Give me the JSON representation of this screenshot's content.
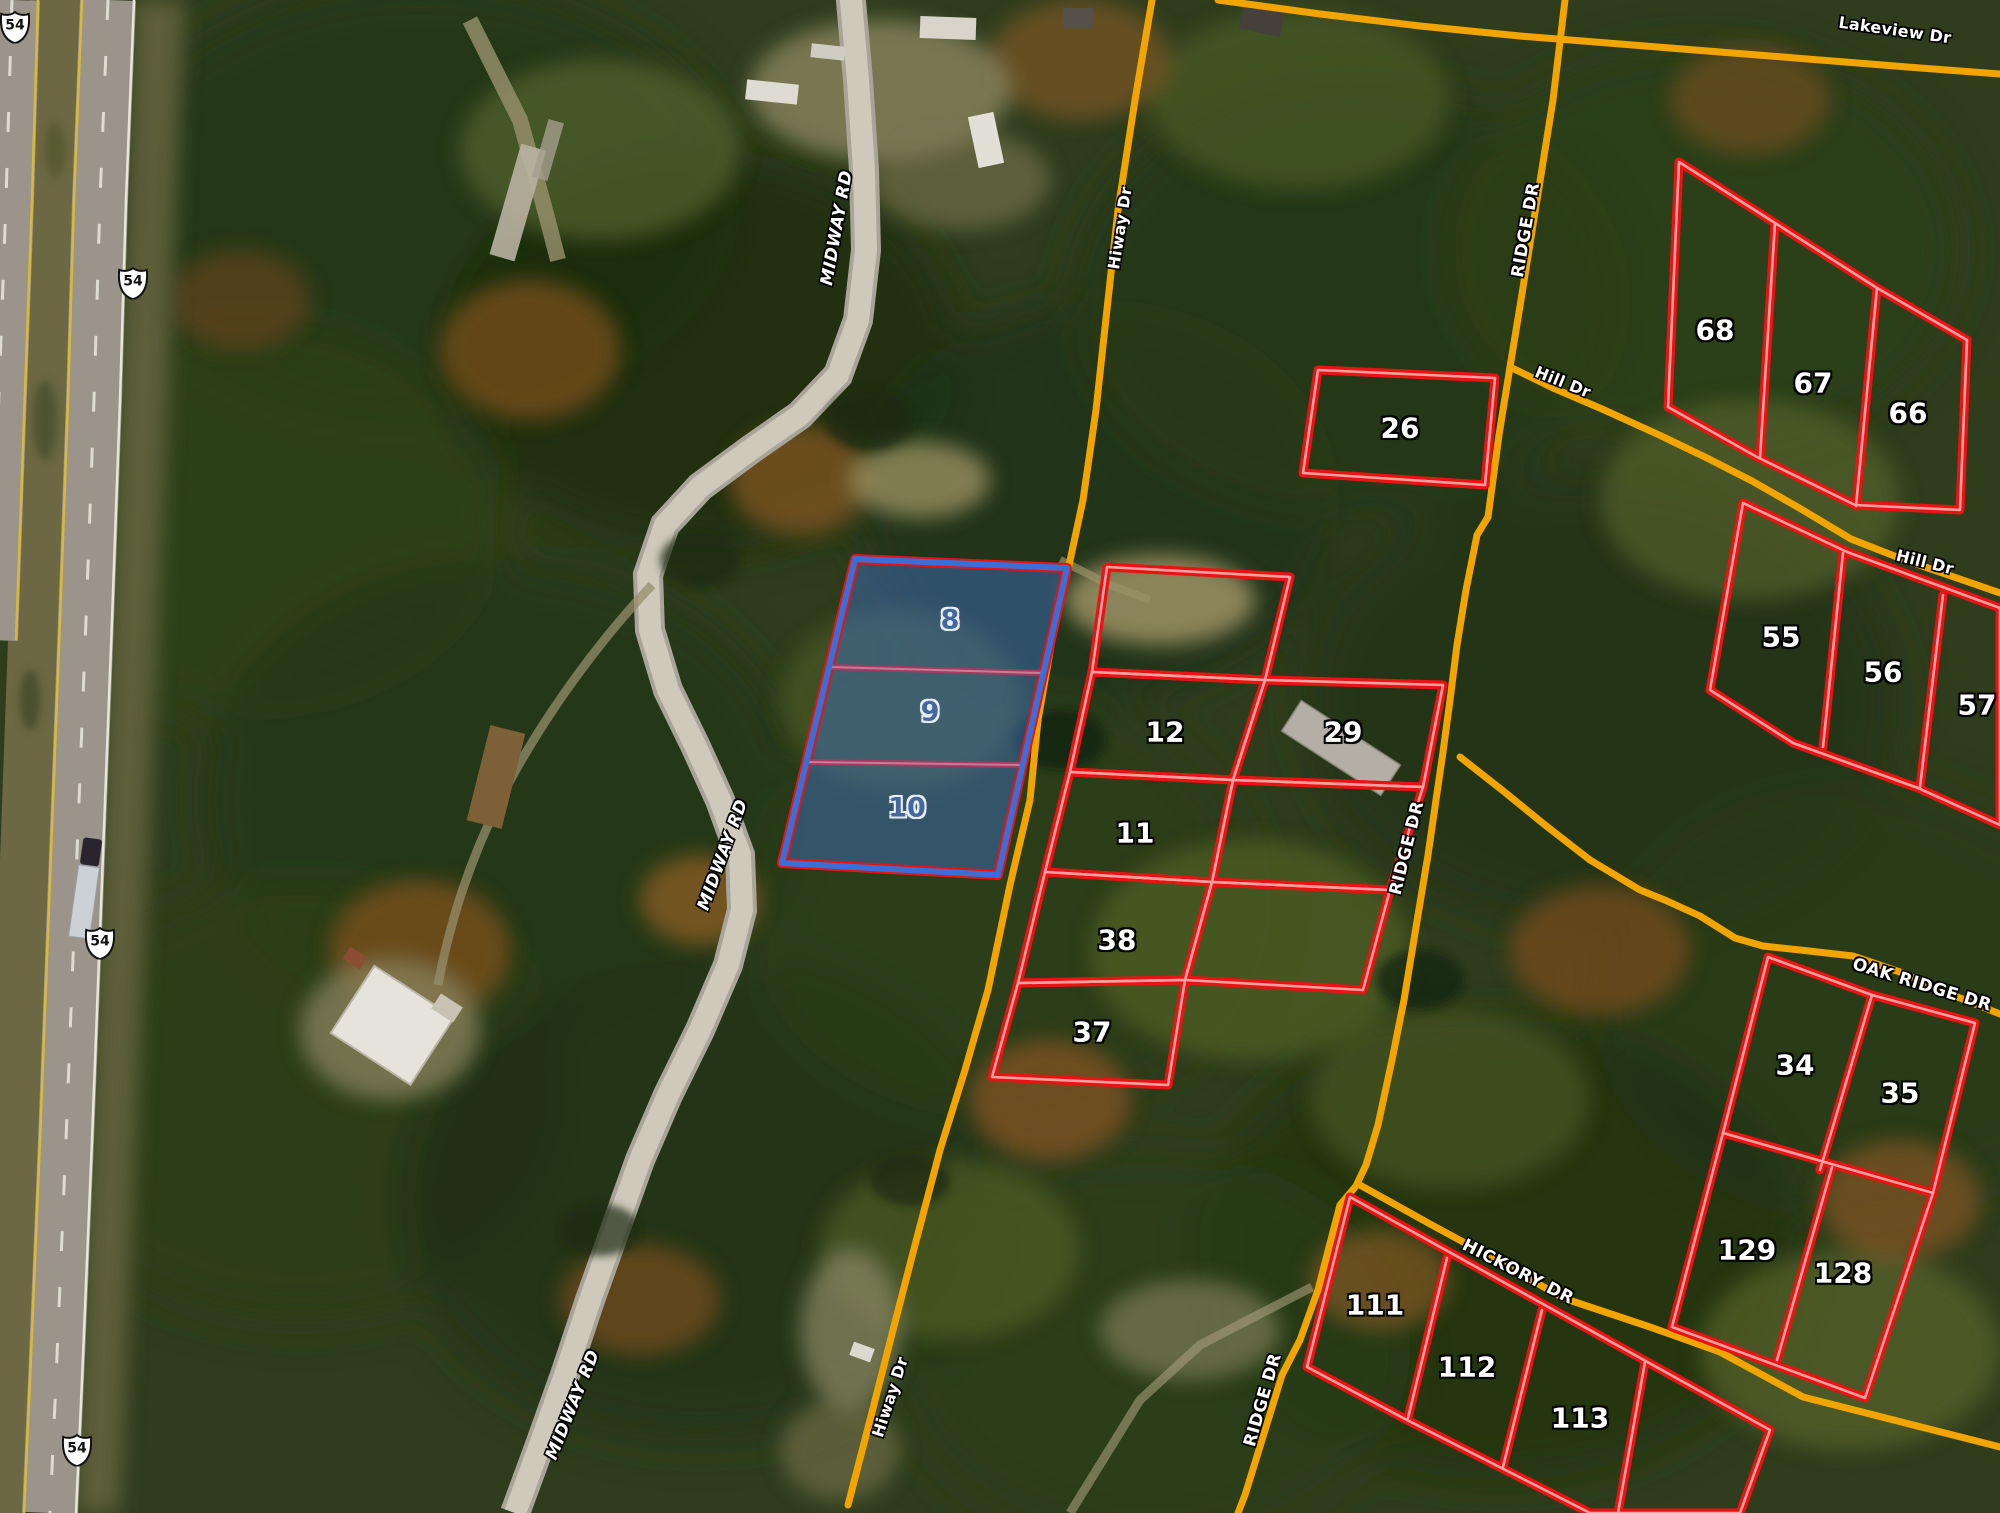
{
  "map": {
    "type": "satellite-parcel-map",
    "highway": {
      "shields": [
        {
          "route": "54"
        },
        {
          "route": "54"
        },
        {
          "route": "54"
        },
        {
          "route": "54"
        }
      ]
    },
    "roads": {
      "labels": [
        {
          "text": "MIDWAY RD"
        },
        {
          "text": "MIDWAY RD"
        },
        {
          "text": "MIDWAY RD"
        },
        {
          "text": "Hiway Dr"
        },
        {
          "text": "Hiway Dr"
        },
        {
          "text": "RIDGE DR"
        },
        {
          "text": "RIDGE DR"
        },
        {
          "text": "RIDGE DR"
        },
        {
          "text": "Hill Dr"
        },
        {
          "text": "Hill Dr"
        },
        {
          "text": "OAK RIDGE DR"
        },
        {
          "text": "HICKORY DR"
        },
        {
          "text": "Lakeview Dr"
        }
      ]
    },
    "parcels": {
      "red": [
        {
          "number": "26"
        },
        {
          "number": "68"
        },
        {
          "number": "67"
        },
        {
          "number": "66"
        },
        {
          "number": "55"
        },
        {
          "number": "56"
        },
        {
          "number": "57"
        },
        {
          "number": "12"
        },
        {
          "number": "29"
        },
        {
          "number": "11"
        },
        {
          "number": "38"
        },
        {
          "number": "37"
        },
        {
          "number": "34"
        },
        {
          "number": "35"
        },
        {
          "number": "129"
        },
        {
          "number": "128"
        },
        {
          "number": "111"
        },
        {
          "number": "112"
        },
        {
          "number": "113"
        }
      ],
      "selected": [
        {
          "number": "8"
        },
        {
          "number": "9"
        },
        {
          "number": "10"
        }
      ]
    },
    "colors": {
      "parcel_outline": "#e81414",
      "parcel_outline_core": "#ff9f9f",
      "selected_fill": "#4074cd",
      "selected_outline": "#3a6fd8",
      "road_highlight": "#f2a500",
      "label_text": "#ffffff",
      "selected_label_text": "#44689c"
    }
  }
}
